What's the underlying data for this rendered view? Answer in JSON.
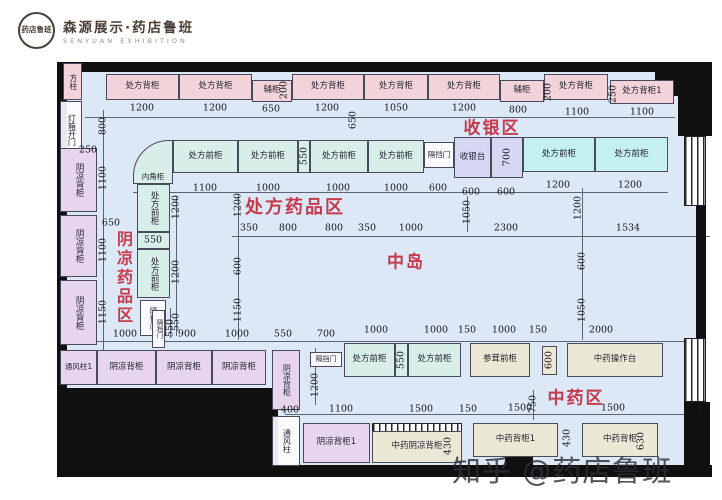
{
  "header": {
    "seal_text": "药店鲁班",
    "brand_cn": "森源展示·药店鲁班",
    "brand_en": "SENYUAN EXHIBITION"
  },
  "watermark": {
    "text": "知乎 @药店鲁班",
    "x": 452,
    "y": 448
  },
  "colors": {
    "floor": "#dce8f5",
    "zone_label": "#c43b4e",
    "wall": "#101010",
    "cabinet_pink": "#f3d3da",
    "cabinet_purple": "#e7d5ee",
    "cabinet_cyan": "#d7eee9",
    "cabinet_cyan_bright": "#c4f0ef",
    "cashier_purple": "#d6d7f2",
    "cabinet_beige": "#ece8d6"
  },
  "zones": [
    {
      "t": "收银区",
      "x": 492,
      "y": 126,
      "fs": 17
    },
    {
      "t": "处方药品区",
      "x": 295,
      "y": 206,
      "fs": 18
    },
    {
      "t": "阴凉药品区",
      "x": 123,
      "y": 278,
      "fs": 16,
      "v": 1
    },
    {
      "t": "中岛",
      "x": 406,
      "y": 260,
      "fs": 17
    },
    {
      "t": "中药区",
      "x": 576,
      "y": 396,
      "fs": 17
    }
  ],
  "floor": {
    "x": 66,
    "y": 71,
    "w": 630,
    "h": 396
  },
  "walls": [
    {
      "x": 57,
      "y": 62,
      "w": 600,
      "h": 10
    },
    {
      "x": 655,
      "y": 62,
      "w": 57,
      "h": 34
    },
    {
      "x": 678,
      "y": 96,
      "w": 34,
      "h": 40
    },
    {
      "x": 57,
      "y": 62,
      "w": 10,
      "h": 334
    },
    {
      "x": 57,
      "y": 388,
      "w": 221,
      "h": 89
    },
    {
      "x": 278,
      "y": 465,
      "w": 434,
      "h": 12
    },
    {
      "x": 696,
      "y": 206,
      "w": 10,
      "h": 132
    },
    {
      "x": 684,
      "y": 402,
      "w": 26,
      "h": 75
    },
    {
      "x": 505,
      "y": 455,
      "w": 28,
      "h": 12
    }
  ],
  "windows": [
    {
      "x": 684,
      "y": 136,
      "w": 22,
      "h": 70
    },
    {
      "x": 684,
      "y": 338,
      "w": 22,
      "h": 64
    },
    {
      "x": 372,
      "y": 423,
      "w": 90,
      "h": 9
    }
  ],
  "dim_lines": [
    {
      "x": 85,
      "y": 117,
      "w": 590,
      "h": 1
    },
    {
      "x": 133,
      "y": 192,
      "w": 535,
      "h": 1
    },
    {
      "x": 232,
      "y": 236,
      "w": 478,
      "h": 1
    },
    {
      "x": 60,
      "y": 341,
      "w": 643,
      "h": 1
    },
    {
      "x": 285,
      "y": 414,
      "w": 418,
      "h": 1
    },
    {
      "x": 103,
      "y": 110,
      "w": 1,
      "h": 240
    },
    {
      "x": 238,
      "y": 195,
      "w": 1,
      "h": 145
    },
    {
      "x": 176,
      "y": 196,
      "w": 1,
      "h": 140
    },
    {
      "x": 467,
      "y": 196,
      "w": 1,
      "h": 36
    },
    {
      "x": 582,
      "y": 188,
      "w": 1,
      "h": 152
    },
    {
      "x": 315,
      "y": 348,
      "w": 1,
      "h": 57
    },
    {
      "x": 533,
      "y": 390,
      "w": 1,
      "h": 30
    },
    {
      "x": 170,
      "y": 308,
      "w": 1,
      "h": 30
    }
  ],
  "cabinets": [
    {
      "t": "方柱",
      "x": 63,
      "y": 63,
      "w": 19,
      "h": 37,
      "c": "pink",
      "v": 1,
      "fs": 8
    },
    {
      "t": "处方背柜",
      "x": 106,
      "y": 74,
      "w": 73,
      "h": 26,
      "c": "pink"
    },
    {
      "t": "处方背柜",
      "x": 179,
      "y": 74,
      "w": 73,
      "h": 26,
      "c": "pink"
    },
    {
      "t": "辅柜",
      "x": 252,
      "y": 80,
      "w": 40,
      "h": 22,
      "c": "pink"
    },
    {
      "t": "处方背柜",
      "x": 292,
      "y": 74,
      "w": 72,
      "h": 26,
      "c": "pink"
    },
    {
      "t": "处方背柜",
      "x": 364,
      "y": 74,
      "w": 64,
      "h": 26,
      "c": "pink"
    },
    {
      "t": "处方背柜",
      "x": 428,
      "y": 74,
      "w": 72,
      "h": 26,
      "c": "pink"
    },
    {
      "t": "辅柜",
      "x": 500,
      "y": 80,
      "w": 44,
      "h": 22,
      "c": "pink"
    },
    {
      "t": "处方背柜",
      "x": 544,
      "y": 74,
      "w": 64,
      "h": 26,
      "c": "pink"
    },
    {
      "t": "处方背柜1",
      "x": 610,
      "y": 80,
      "w": 64,
      "h": 24,
      "c": "pink"
    },
    {
      "t": "内角柜",
      "x": 133,
      "y": 140,
      "w": 40,
      "h": 44,
      "c": "cyan",
      "corner": 1,
      "fs": 7.5
    },
    {
      "t": "处方前柜",
      "x": 173,
      "y": 140,
      "w": 65,
      "h": 33,
      "c": "cyan"
    },
    {
      "t": "处方前柜",
      "x": 238,
      "y": 140,
      "w": 60,
      "h": 33,
      "c": "cyan"
    },
    {
      "t": "",
      "x": 298,
      "y": 140,
      "w": 12,
      "h": 33,
      "c": "cyan"
    },
    {
      "t": "处方前柜",
      "x": 310,
      "y": 140,
      "w": 58,
      "h": 33,
      "c": "cyan"
    },
    {
      "t": "处方前柜",
      "x": 368,
      "y": 140,
      "w": 56,
      "h": 33,
      "c": "cyan"
    },
    {
      "t": "隔挡门",
      "x": 424,
      "y": 142,
      "w": 30,
      "h": 26,
      "c": "none",
      "fs": 7.5
    },
    {
      "t": "收银台",
      "x": 454,
      "y": 137,
      "w": 37,
      "h": 41,
      "c": "pb"
    },
    {
      "t": "",
      "x": 491,
      "y": 137,
      "w": 32,
      "h": 41,
      "c": "pb"
    },
    {
      "t": "处方前柜",
      "x": 523,
      "y": 137,
      "w": 72,
      "h": 35,
      "c": "cyan2"
    },
    {
      "t": "处方前柜",
      "x": 595,
      "y": 137,
      "w": 73,
      "h": 35,
      "c": "cyan2"
    },
    {
      "t": "灯箱开门",
      "x": 60,
      "y": 101,
      "w": 22,
      "h": 57,
      "c": "none",
      "v": 1,
      "fs": 8
    },
    {
      "t": "阴凉背柜",
      "x": 60,
      "y": 148,
      "w": 37,
      "h": 64,
      "c": "purple",
      "v": 1
    },
    {
      "t": "阴凉背柜",
      "x": 60,
      "y": 215,
      "w": 37,
      "h": 62,
      "c": "purple",
      "v": 1
    },
    {
      "t": "阴凉背柜",
      "x": 60,
      "y": 280,
      "w": 37,
      "h": 65,
      "c": "purple",
      "v": 1
    },
    {
      "t": "处方前柜",
      "x": 137,
      "y": 184,
      "w": 33,
      "h": 48,
      "c": "cyan",
      "v": 1
    },
    {
      "t": "",
      "x": 137,
      "y": 232,
      "w": 33,
      "h": 17,
      "c": "cyan"
    },
    {
      "t": "处方前柜",
      "x": 137,
      "y": 249,
      "w": 33,
      "h": 49,
      "c": "cyan",
      "v": 1
    },
    {
      "t": "隔挡门",
      "x": 140,
      "y": 300,
      "w": 26,
      "h": 36,
      "c": "none",
      "v": 1,
      "fs": 7.5
    },
    {
      "t": "通风柱1",
      "x": 60,
      "y": 350,
      "w": 37,
      "h": 35,
      "c": "purple",
      "fs": 7.5
    },
    {
      "t": "阴凉背柜",
      "x": 97,
      "y": 350,
      "w": 59,
      "h": 35,
      "c": "purple"
    },
    {
      "t": "隔挡门",
      "x": 152,
      "y": 310,
      "w": 13,
      "h": 38,
      "c": "none",
      "v": 1,
      "fs": 6.5
    },
    {
      "t": "阴凉背柜",
      "x": 156,
      "y": 350,
      "w": 56,
      "h": 35,
      "c": "purple"
    },
    {
      "t": "阴凉背柜",
      "x": 212,
      "y": 350,
      "w": 54,
      "h": 35,
      "c": "purple"
    },
    {
      "t": "阴凉背柜",
      "x": 272,
      "y": 350,
      "w": 28,
      "h": 60,
      "c": "purple",
      "v": 1,
      "fs": 8
    },
    {
      "t": "通风柱",
      "x": 272,
      "y": 416,
      "w": 28,
      "h": 50,
      "c": "none",
      "v": 1,
      "fs": 8
    },
    {
      "t": "隔挡门",
      "x": 310,
      "y": 352,
      "w": 32,
      "h": 15,
      "c": "none",
      "fs": 7
    },
    {
      "t": "处方前柜",
      "x": 344,
      "y": 343,
      "w": 51,
      "h": 34,
      "c": "cyan"
    },
    {
      "t": "",
      "x": 395,
      "y": 343,
      "w": 13,
      "h": 34,
      "c": "cyan"
    },
    {
      "t": "处方前柜",
      "x": 408,
      "y": 343,
      "w": 53,
      "h": 34,
      "c": "cyan"
    },
    {
      "t": "参茸前柜",
      "x": 470,
      "y": 343,
      "w": 60,
      "h": 34,
      "c": "beige"
    },
    {
      "t": "",
      "x": 542,
      "y": 346,
      "w": 15,
      "h": 29,
      "c": "beige"
    },
    {
      "t": "中药操作台",
      "x": 567,
      "y": 343,
      "w": 96,
      "h": 34,
      "c": "beige"
    },
    {
      "t": "阴凉背柜1",
      "x": 303,
      "y": 423,
      "w": 67,
      "h": 40,
      "c": "purple"
    },
    {
      "t": "中药阴凉背柜",
      "x": 372,
      "y": 431,
      "w": 90,
      "h": 32,
      "c": "beige"
    },
    {
      "t": "中药背柜1",
      "x": 473,
      "y": 423,
      "w": 85,
      "h": 34,
      "c": "beige"
    },
    {
      "t": "中药背柜",
      "x": 582,
      "y": 423,
      "w": 76,
      "h": 34,
      "c": "beige"
    }
  ],
  "islands": [
    {
      "x": 239,
      "y": 242,
      "w": 139,
      "h": 39,
      "bases": [
        23,
        118
      ],
      "divs": [
        71
      ]
    },
    {
      "x": 438,
      "y": 242,
      "w": 140,
      "h": 39,
      "bases": [
        23,
        117
      ],
      "divs": [
        70
      ]
    }
  ],
  "dims": [
    {
      "t": "1200",
      "x": 142,
      "y": 108
    },
    {
      "t": "1200",
      "x": 215,
      "y": 108
    },
    {
      "t": "650",
      "x": 271,
      "y": 109
    },
    {
      "t": "1200",
      "x": 327,
      "y": 108
    },
    {
      "t": "1050",
      "x": 396,
      "y": 108
    },
    {
      "t": "1200",
      "x": 464,
      "y": 108
    },
    {
      "t": "800",
      "x": 518,
      "y": 110
    },
    {
      "t": "1100",
      "x": 577,
      "y": 112
    },
    {
      "t": "1100",
      "x": 642,
      "y": 112
    },
    {
      "t": "800",
      "x": 103,
      "y": 126,
      "v": 1
    },
    {
      "t": "200",
      "x": 284,
      "y": 90,
      "v": 1
    },
    {
      "t": "650",
      "x": 353,
      "y": 120,
      "v": 1
    },
    {
      "t": "200",
      "x": 548,
      "y": 92,
      "v": 1
    },
    {
      "t": "250",
      "x": 613,
      "y": 94,
      "v": 1
    },
    {
      "t": "250",
      "x": 88,
      "y": 150
    },
    {
      "t": "1100",
      "x": 205,
      "y": 188
    },
    {
      "t": "1000",
      "x": 268,
      "y": 188
    },
    {
      "t": "1000",
      "x": 338,
      "y": 188
    },
    {
      "t": "1000",
      "x": 396,
      "y": 188
    },
    {
      "t": "600",
      "x": 438,
      "y": 188
    },
    {
      "t": "600",
      "x": 471,
      "y": 192
    },
    {
      "t": "600",
      "x": 506,
      "y": 192
    },
    {
      "t": "1200",
      "x": 558,
      "y": 185
    },
    {
      "t": "1200",
      "x": 630,
      "y": 185
    },
    {
      "t": "550",
      "x": 304,
      "y": 156,
      "v": 1
    },
    {
      "t": "700",
      "x": 507,
      "y": 157,
      "v": 1
    },
    {
      "t": "550",
      "x": 153,
      "y": 240
    },
    {
      "t": "550",
      "x": 401,
      "y": 360,
      "v": 1
    },
    {
      "t": "600",
      "x": 549,
      "y": 360,
      "v": 1
    },
    {
      "t": "1100",
      "x": 103,
      "y": 178,
      "v": 1
    },
    {
      "t": "1100",
      "x": 103,
      "y": 250,
      "v": 1
    },
    {
      "t": "1150",
      "x": 103,
      "y": 312,
      "v": 1
    },
    {
      "t": "650",
      "x": 111,
      "y": 223
    },
    {
      "t": "1200",
      "x": 176,
      "y": 207,
      "v": 1
    },
    {
      "t": "1200",
      "x": 176,
      "y": 272,
      "v": 1
    },
    {
      "t": "550",
      "x": 176,
      "y": 322,
      "v": 1
    },
    {
      "t": "1200",
      "x": 238,
      "y": 205,
      "v": 1
    },
    {
      "t": "600",
      "x": 238,
      "y": 266,
      "v": 1
    },
    {
      "t": "1150",
      "x": 238,
      "y": 310,
      "v": 1
    },
    {
      "t": "1050",
      "x": 467,
      "y": 212,
      "v": 1
    },
    {
      "t": "1200",
      "x": 578,
      "y": 208,
      "v": 1
    },
    {
      "t": "600",
      "x": 582,
      "y": 261,
      "v": 1
    },
    {
      "t": "1050",
      "x": 582,
      "y": 310,
      "v": 1
    },
    {
      "t": "350",
      "x": 249,
      "y": 228
    },
    {
      "t": "800",
      "x": 288,
      "y": 228
    },
    {
      "t": "800",
      "x": 334,
      "y": 228
    },
    {
      "t": "350",
      "x": 367,
      "y": 228
    },
    {
      "t": "1000",
      "x": 411,
      "y": 228
    },
    {
      "t": "2300",
      "x": 506,
      "y": 228
    },
    {
      "t": "1534",
      "x": 628,
      "y": 228
    },
    {
      "t": "1000",
      "x": 125,
      "y": 334
    },
    {
      "t": "900",
      "x": 187,
      "y": 334
    },
    {
      "t": "1000",
      "x": 237,
      "y": 334
    },
    {
      "t": "550",
      "x": 283,
      "y": 334
    },
    {
      "t": "700",
      "x": 326,
      "y": 334
    },
    {
      "t": "1000",
      "x": 376,
      "y": 330
    },
    {
      "t": "1000",
      "x": 436,
      "y": 330
    },
    {
      "t": "150",
      "x": 467,
      "y": 330
    },
    {
      "t": "1000",
      "x": 504,
      "y": 330
    },
    {
      "t": "150",
      "x": 538,
      "y": 330
    },
    {
      "t": "2000",
      "x": 601,
      "y": 330
    },
    {
      "t": "550",
      "x": 170,
      "y": 328,
      "v": 1
    },
    {
      "t": "1200",
      "x": 315,
      "y": 385,
      "v": 1
    },
    {
      "t": "750",
      "x": 533,
      "y": 404,
      "v": 1
    },
    {
      "t": "430",
      "x": 448,
      "y": 446,
      "v": 1
    },
    {
      "t": "430",
      "x": 567,
      "y": 438,
      "v": 1
    },
    {
      "t": "630",
      "x": 641,
      "y": 441,
      "v": 1
    },
    {
      "t": "400",
      "x": 290,
      "y": 410
    },
    {
      "t": "1100",
      "x": 341,
      "y": 409
    },
    {
      "t": "1500",
      "x": 421,
      "y": 409
    },
    {
      "t": "150",
      "x": 468,
      "y": 409
    },
    {
      "t": "1500",
      "x": 520,
      "y": 408
    },
    {
      "t": "1500",
      "x": 613,
      "y": 408
    },
    {
      "t": "150",
      "x": 694,
      "y": 410
    }
  ]
}
